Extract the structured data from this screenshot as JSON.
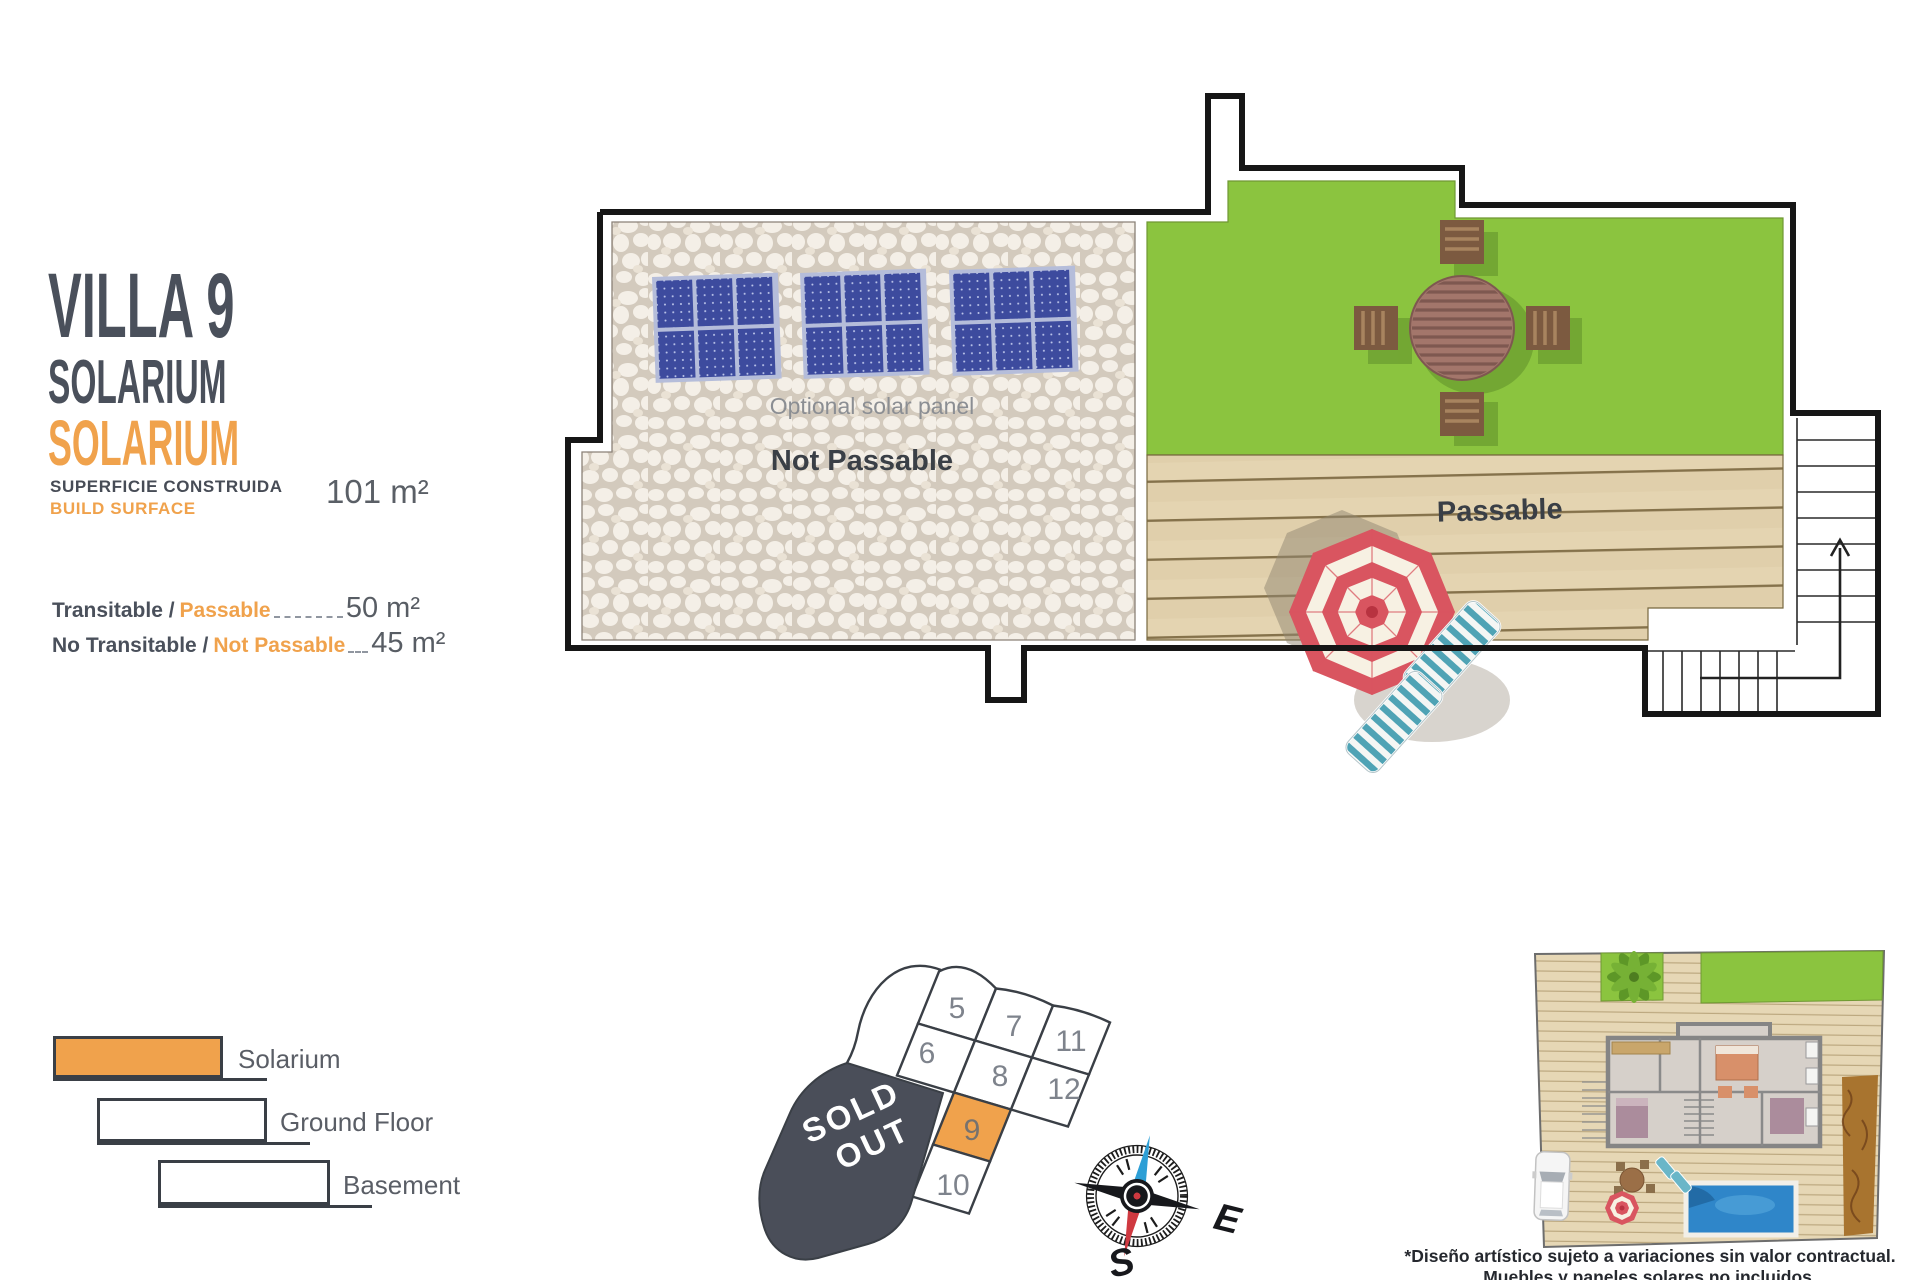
{
  "header": {
    "title": "VILLA 9",
    "floor_es": "SOLARIUM",
    "floor_en": "SOLARIUM",
    "build_surface_es": "SUPERFICIE CONSTRUIDA",
    "build_surface_en": "BUILD SURFACE",
    "build_surface_value": "101 m²",
    "areas": [
      {
        "label_es": "Transitable /",
        "label_en": "Passable",
        "value": "50 m²"
      },
      {
        "label_es": "No Transitable /",
        "label_en": "Not Passable",
        "value": "45 m²"
      }
    ]
  },
  "plan": {
    "solar_panel_note": "Optional solar panel",
    "not_passable_label": "Not Passable",
    "passable_label": "Passable"
  },
  "legend": {
    "items": [
      {
        "label": "Solarium"
      },
      {
        "label": "Ground Floor"
      },
      {
        "label": "Basement"
      }
    ]
  },
  "plot_map": {
    "sold_out_line1": "SOLD",
    "sold_out_line2": "OUT",
    "highlighted_plot": "9",
    "plots": [
      "5",
      "7",
      "11",
      "6",
      "8",
      "12",
      "9",
      "10"
    ]
  },
  "compass": {
    "east": "E",
    "south": "S"
  },
  "disclaimer": {
    "line1": "*Diseño artístico sujeto a variaciones sin valor contractual.",
    "line2": "Muebles y paneles solares no incluidos."
  },
  "colors": {
    "accent_orange": "#F0A24C",
    "dark_charcoal": "#3A3F46",
    "grass_green": "#8BC43F",
    "deck_tan": "#E4D4B1",
    "panel_blue": "#3D4B9E",
    "sold_out_gray": "#4A4E59"
  }
}
